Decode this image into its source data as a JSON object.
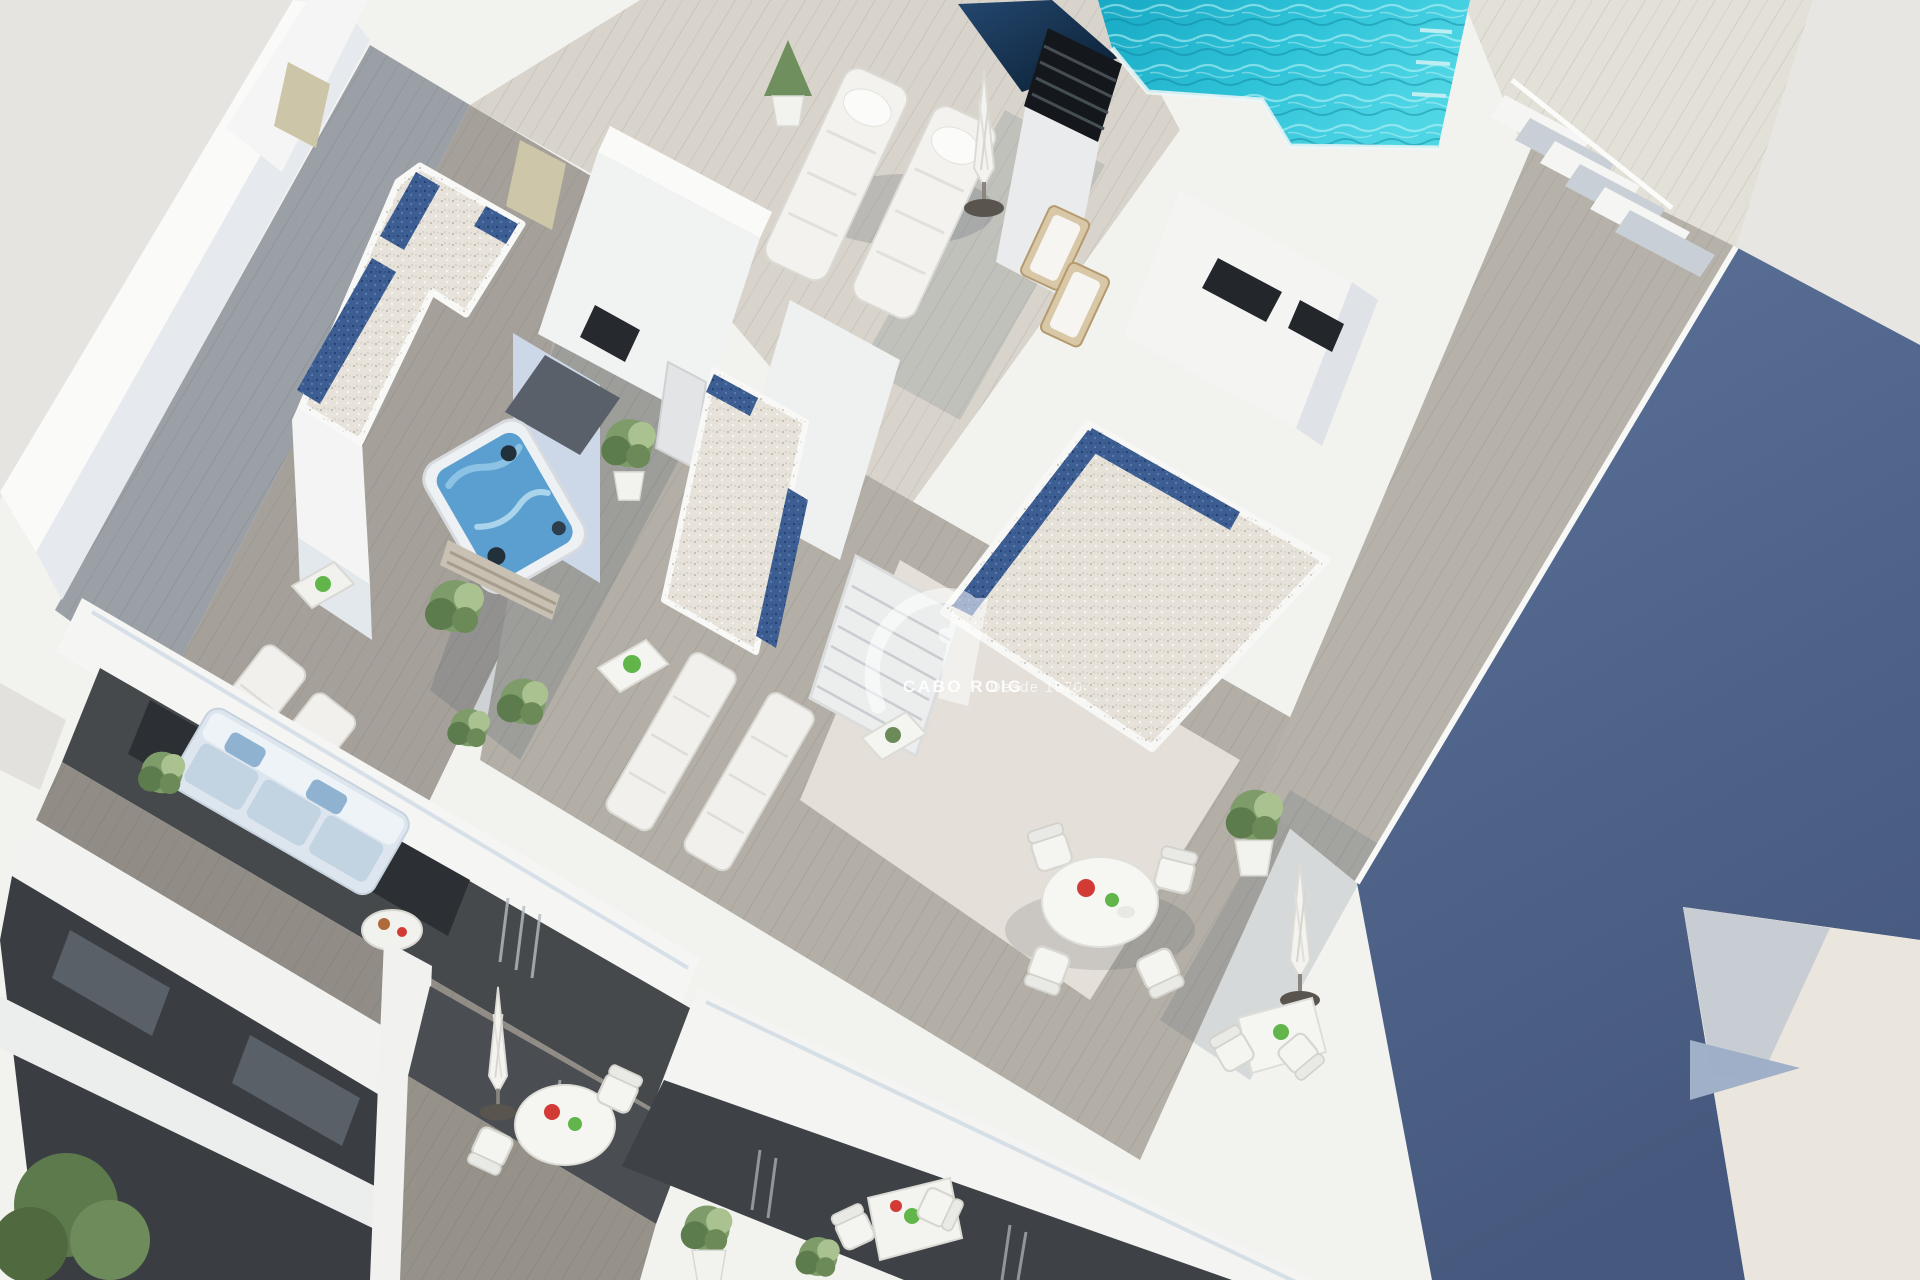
{
  "meta": {
    "type": "3d-architectural-render",
    "view": "aerial view of residential building rooftop solarium"
  },
  "watermark": {
    "brand": "CABO ROIG",
    "tagline": "Desde 1970"
  },
  "palette": {
    "background": "#e8e6e3",
    "white_lit": "#f6f6f4",
    "white_shade": "#e6eaee",
    "deck_shade": "#9aa0a6",
    "deck_mid": "#aca89f",
    "deck_lit": "#d7d3ca",
    "gravel_white": "#e7e3da",
    "gravel_blue": "#3d5e92",
    "pool_water": "#2fbdd3",
    "pool_deep": "#0f9cb8",
    "glass_screen": "#16324f",
    "shadow_wall": "#54698f",
    "sunlit_side_wall": "#eae6de",
    "balcony_interior": "#43474c",
    "sofa_fabric": "#c9d6e2",
    "foliage": "#7d9c6a",
    "wood_accent": "#c4b394",
    "accent_red": "#d23b35",
    "accent_green": "#62b54a"
  },
  "scene": {
    "objects": [
      "swimming pool with stairs",
      "glass wind screen",
      "ventilation chimney",
      "jacuzzi hot tub",
      "white gravel roofs with blue pebble borders",
      "wooden deck terraces",
      "sun loungers",
      "closed parasols",
      "round and square dining sets",
      "potted plants",
      "balconies with sofa and tables",
      "neighbouring wall in shadow"
    ]
  }
}
